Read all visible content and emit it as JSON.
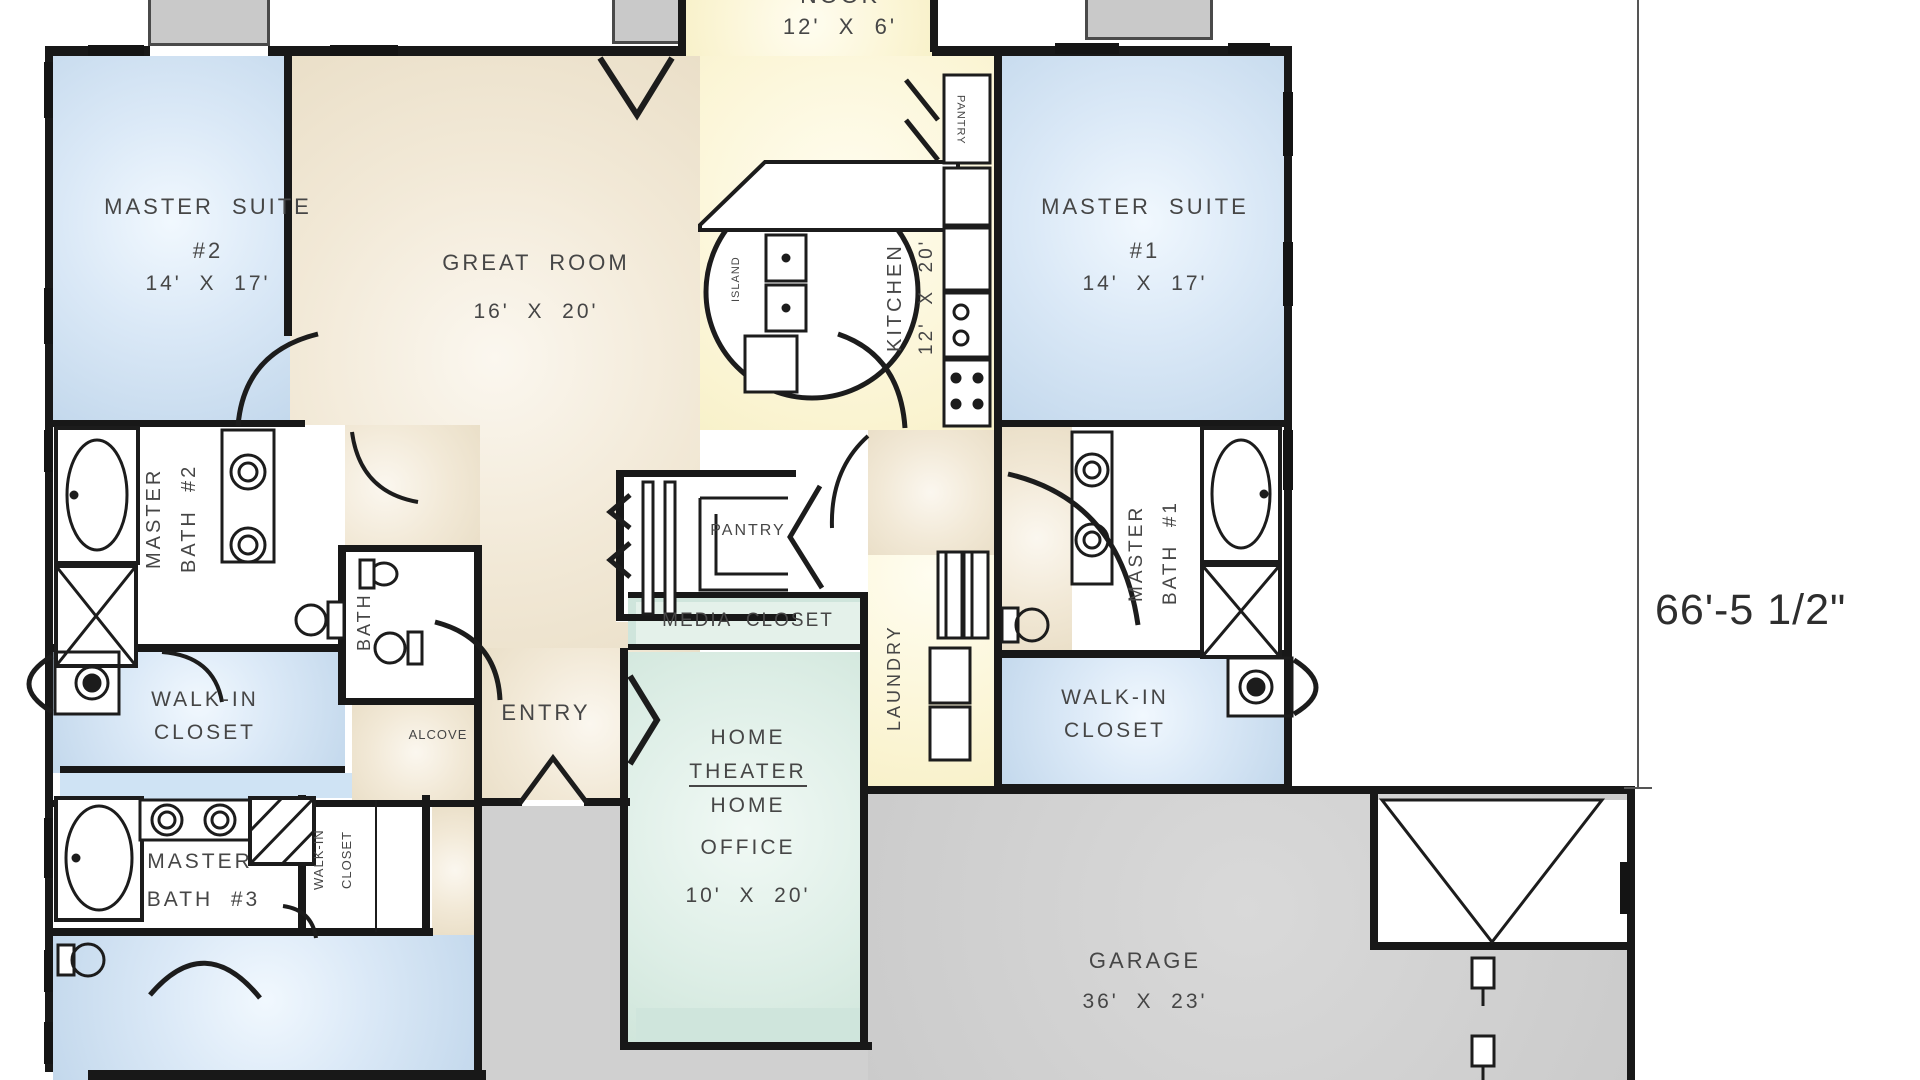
{
  "title": "house-floor-plan",
  "labels": {
    "nook_name": "NOOK",
    "nook_dims": "12'  X  6'",
    "master_suite_2_name": "MASTER  SUITE",
    "master_suite_2_num": "#2",
    "master_suite_2_dims": "14'  X  17'",
    "great_room_name": "GREAT  ROOM",
    "great_room_dims": "16'  X  20'",
    "kitchen_name": "KITCHEN",
    "kitchen_dims": "12'  X  20'",
    "island": "ISLAND",
    "pantry_cabinet": "PANTRY",
    "master_suite_1_name": "MASTER  SUITE",
    "master_suite_1_num": "#1",
    "master_suite_1_dims": "14'  X  17'",
    "master_bath_2_l1": "MASTER",
    "master_bath_2_l2": "BATH  #2",
    "bath": "BATH",
    "walk_in_closet_left_l1": "WALK-IN",
    "walk_in_closet_left_l2": "CLOSET",
    "alcove": "ALCOVE",
    "entry": "ENTRY",
    "pantry_room": "PANTRY",
    "media_closet": "MEDIA  CLOSET",
    "home_theater_l1": "HOME",
    "home_theater_l2": "THEATER",
    "home_theater_l3": "HOME",
    "home_theater_l4": "OFFICE",
    "home_theater_dims": "10'  X  20'",
    "laundry": "LAUNDRY",
    "master_bath_1_l1": "MASTER",
    "master_bath_1_l2": "BATH  #1",
    "walk_in_closet_right_l1": "WALK-IN",
    "walk_in_closet_right_l2": "CLOSET",
    "master_bath_3_l1": "MASTER",
    "master_bath_3_l2": "BATH  #3",
    "walk_in_closet_3_l1": "WALK-IN",
    "walk_in_closet_3_l2": "CLOSET",
    "garage_name": "GARAGE",
    "garage_dims": "36'  X  23'",
    "dimension_right": "66'-5 1/2\""
  },
  "colors": {
    "bedroom_blue": "#c3d8ec",
    "living_beige": "#efe6d2",
    "kitchen_yellow": "#fbf5d5",
    "theater_teal": "#ddeee6",
    "garage_gray": "#cbcbcb",
    "wall_black": "#181818",
    "text_gray": "#464646"
  }
}
